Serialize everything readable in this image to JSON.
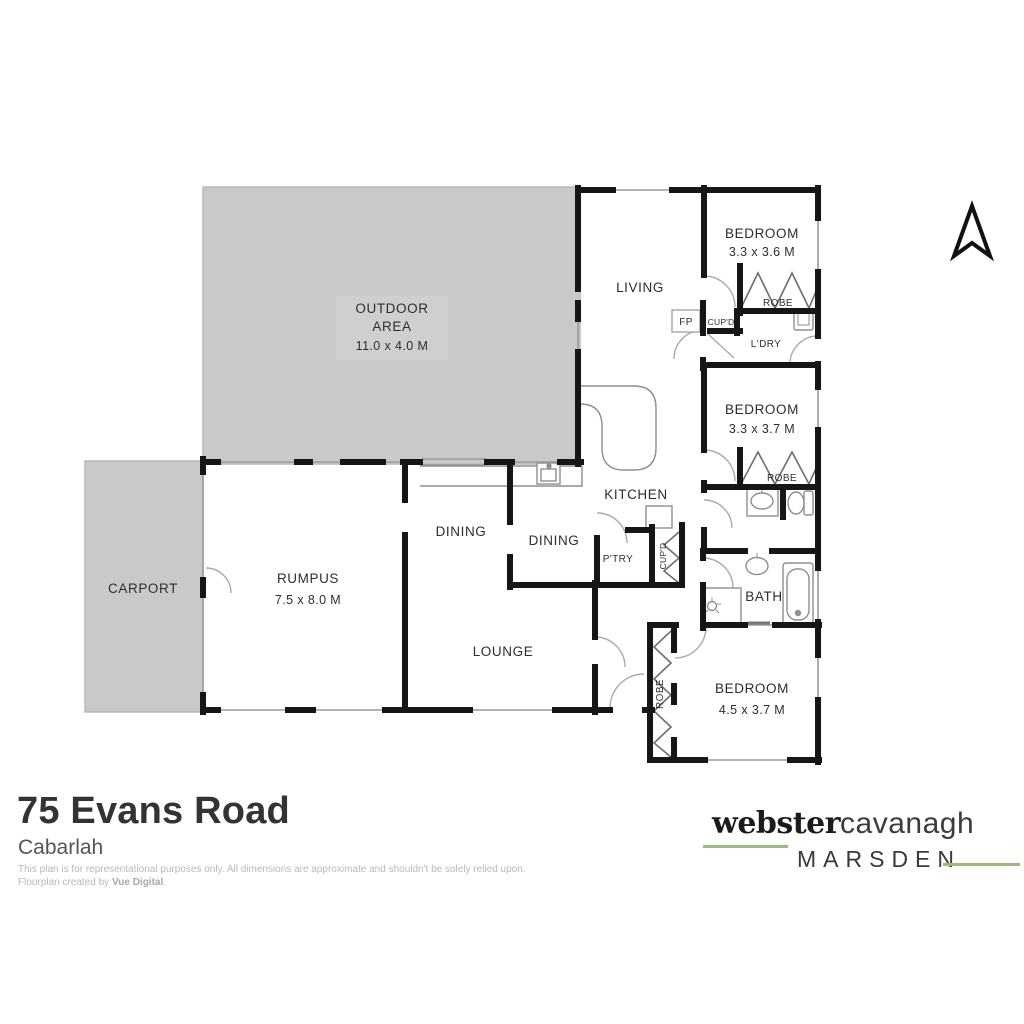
{
  "plan": {
    "rooms": [
      {
        "id": "outdoor",
        "line1": "OUTDOOR",
        "line2": "AREA",
        "dims": "11.0 x 4.0 M"
      },
      {
        "id": "carport",
        "line1": "CARPORT"
      },
      {
        "id": "rumpus",
        "line1": "RUMPUS",
        "dims": "7.5 x 8.0 M"
      },
      {
        "id": "dining-1",
        "line1": "DINING"
      },
      {
        "id": "dining-2",
        "line1": "DINING"
      },
      {
        "id": "lounge",
        "line1": "LOUNGE"
      },
      {
        "id": "kitchen",
        "line1": "KITCHEN"
      },
      {
        "id": "living",
        "line1": "LIVING"
      },
      {
        "id": "bedroom-1",
        "line1": "BEDROOM",
        "dims": "3.3 x 3.6 M"
      },
      {
        "id": "bedroom-2",
        "line1": "BEDROOM",
        "dims": "3.3 x 3.7 M"
      },
      {
        "id": "bedroom-3",
        "line1": "BEDROOM",
        "dims": "4.5 x 3.7 M"
      },
      {
        "id": "bath",
        "line1": "BATH"
      },
      {
        "id": "laundry",
        "line1": "L'DRY"
      },
      {
        "id": "pantry",
        "line1": "P'TRY"
      }
    ],
    "features": {
      "robe": "ROBE",
      "cupboard": "CUP'D",
      "fireplace": "FP"
    }
  },
  "footer": {
    "address": "75 Evans Road",
    "suburb": "Cabarlah",
    "disclaimer_line1": "This plan is for representational purposes only. All dimensions are approximate and shouldn't be solely relied upon.",
    "disclaimer_line2_prefix": "Floorplan created by ",
    "disclaimer_creator": "Vue Digital",
    "disclaimer_line2_suffix": "."
  },
  "brand": {
    "name_primary": "webster",
    "name_secondary": "cavanagh",
    "name_tertiary": "MARSDEN",
    "accent_color": "#9cb97e"
  }
}
